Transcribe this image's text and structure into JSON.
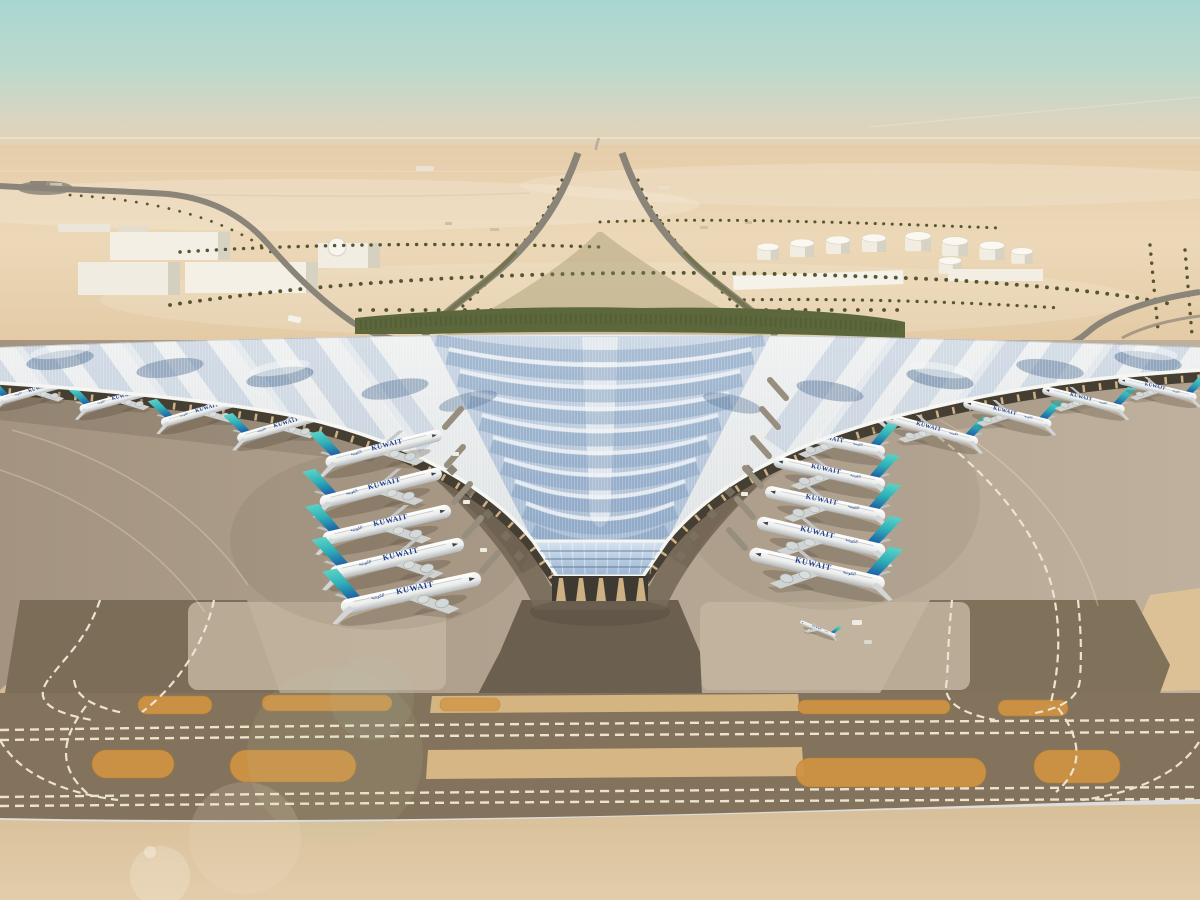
{
  "scene": {
    "title": "Kuwait International Airport terminal — aerial rendering",
    "description": "Aerial architectural rendering of a desert airport terminal with a winged trefoil canopy roof, Kuwait Airways wide-body aircraft parked at gates on both piers, palm-lined landside approach roads, a fuel tank farm, warehouses, and taxiways with amber hold-position markings and dashed white taxi lines.",
    "airline": {
      "title_en": "KUWAIT",
      "title_ar": "الكويتية"
    },
    "aircraft": {
      "left_gate_row": 5,
      "right_gate_row": 6,
      "west_pier": 5,
      "east_pier": 5,
      "remote_stand": 1
    },
    "environment": {
      "setting": "desert",
      "time_of_day": "day",
      "weather": "hazy-clear"
    },
    "colors": {
      "sky_top": "#a9d6d2",
      "horizon_haze": "#e4d2b4",
      "sand": "#e8d2b0",
      "apron": "#b3a492",
      "taxiway_asphalt": "#84735c",
      "hold_marking_amber": "#d09343",
      "taxi_line_white": "#ece4cf",
      "roof_silver": "#e7eaeb",
      "roof_blue": "#8fa9c8",
      "tail_teal": "#5bd2c6",
      "tail_blue": "#1b57a3",
      "airline_navy": "#1e3e8c",
      "landscape_green": "#5c683c"
    }
  }
}
